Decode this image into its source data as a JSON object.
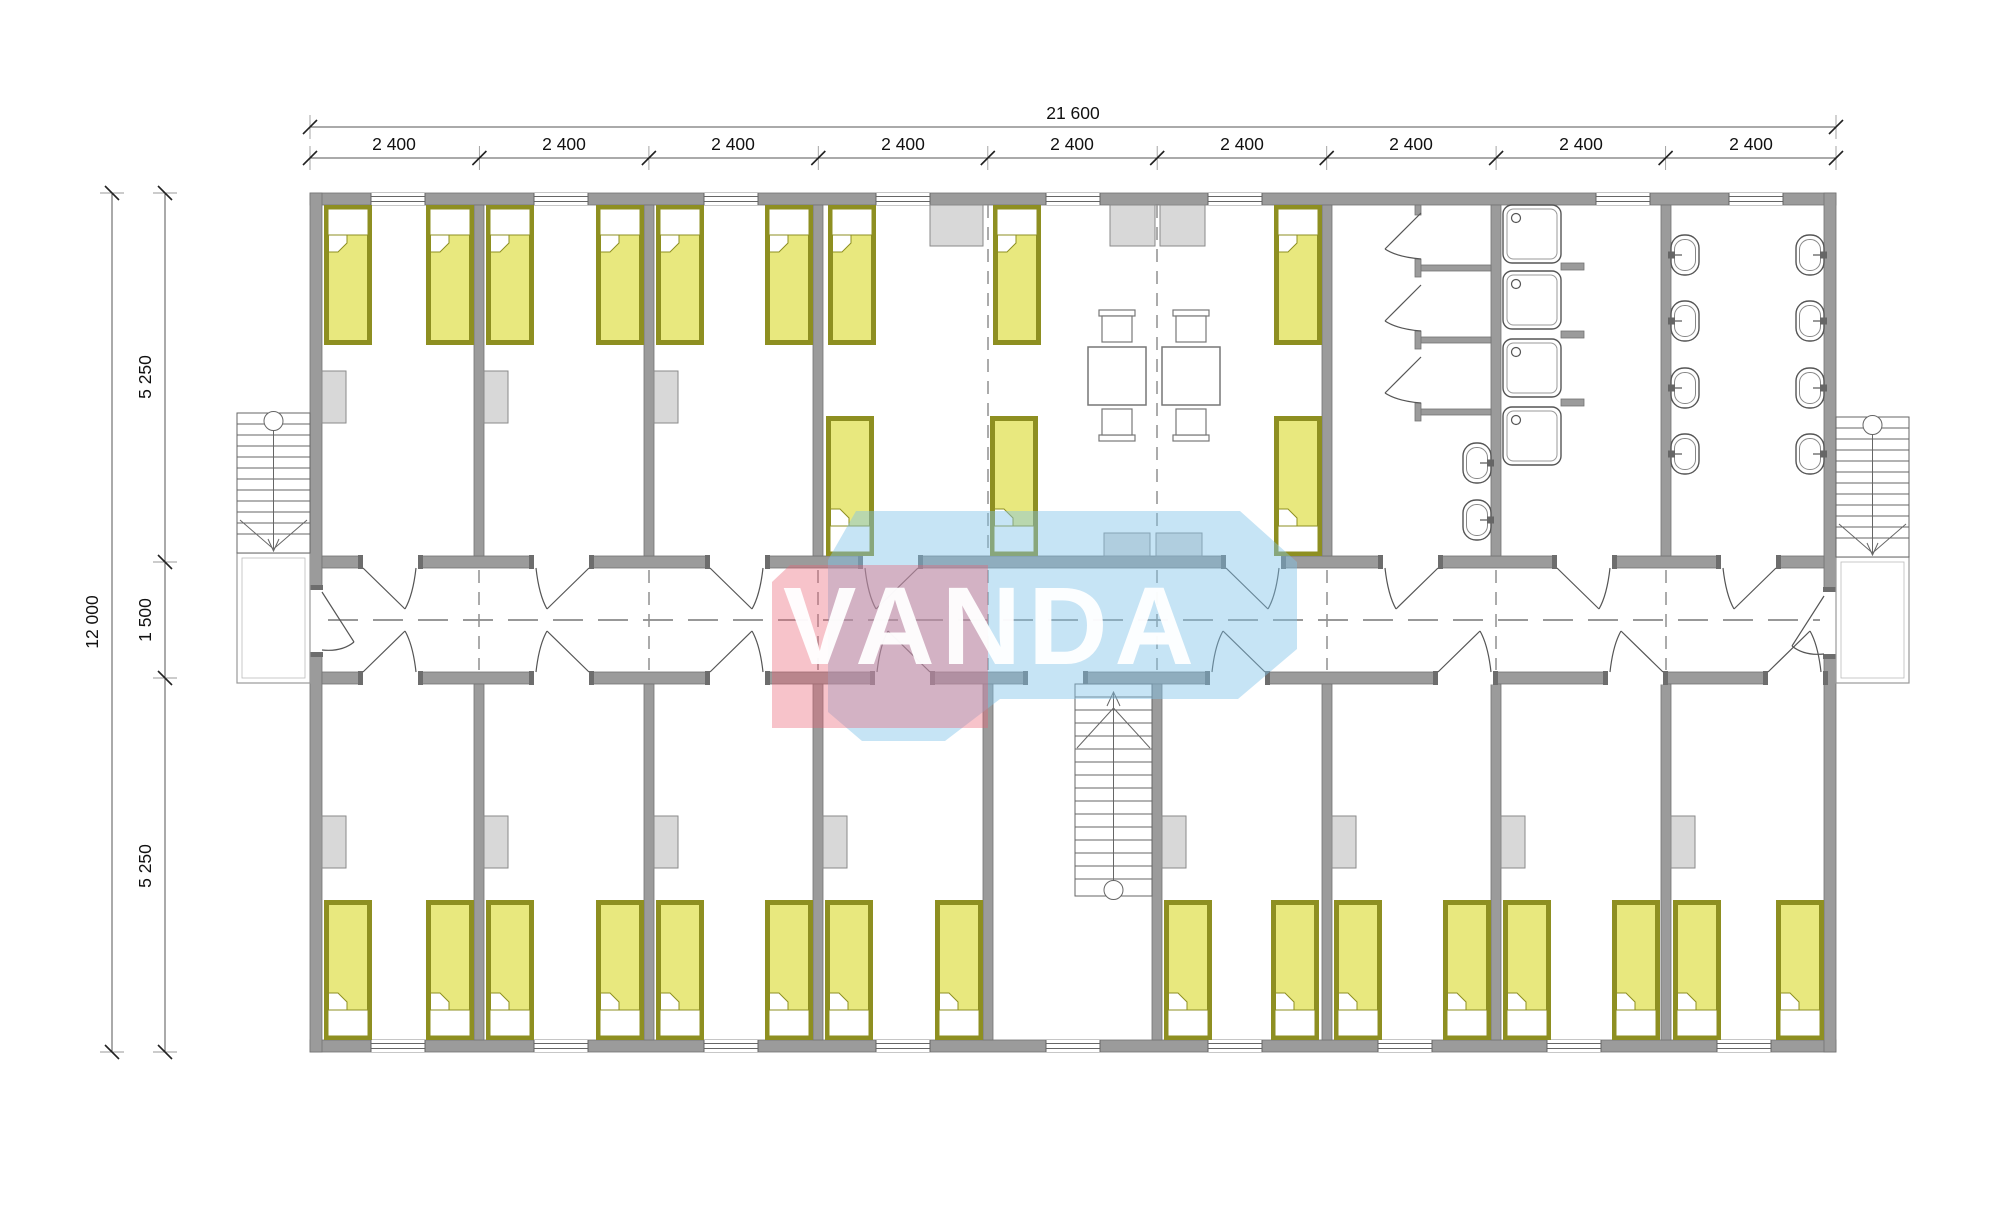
{
  "watermark": {
    "text": "VANDA"
  },
  "dimensions": {
    "overall_width": "21 600",
    "overall_depth": "12 000",
    "bay_segments": [
      "2 400",
      "2 400",
      "2 400",
      "2 400",
      "2 400",
      "2 400",
      "2 400",
      "2 400",
      "2 400"
    ],
    "depth_segments": [
      "5 250",
      "1 500",
      "5 250"
    ]
  },
  "colors": {
    "wall": "#9b9b9b",
    "bed_fill": "#e8e87e",
    "bed_border": "#8e8f21",
    "wardrobe_fill": "#d8d8d8",
    "watermark_pink": "rgba(233,96,115,0.38)",
    "watermark_blue": "rgba(128,196,233,0.45)",
    "watermark_text": "rgba(255,255,255,0.95)"
  },
  "plan_summary": {
    "type": "modular dormitory floor plan",
    "single_beds": 28,
    "dining_tables": 2,
    "chairs": 4,
    "shower_trays": 4,
    "wash_basins": 10,
    "toilet_stalls": 3,
    "staircases": 3,
    "wardrobes": 16
  }
}
